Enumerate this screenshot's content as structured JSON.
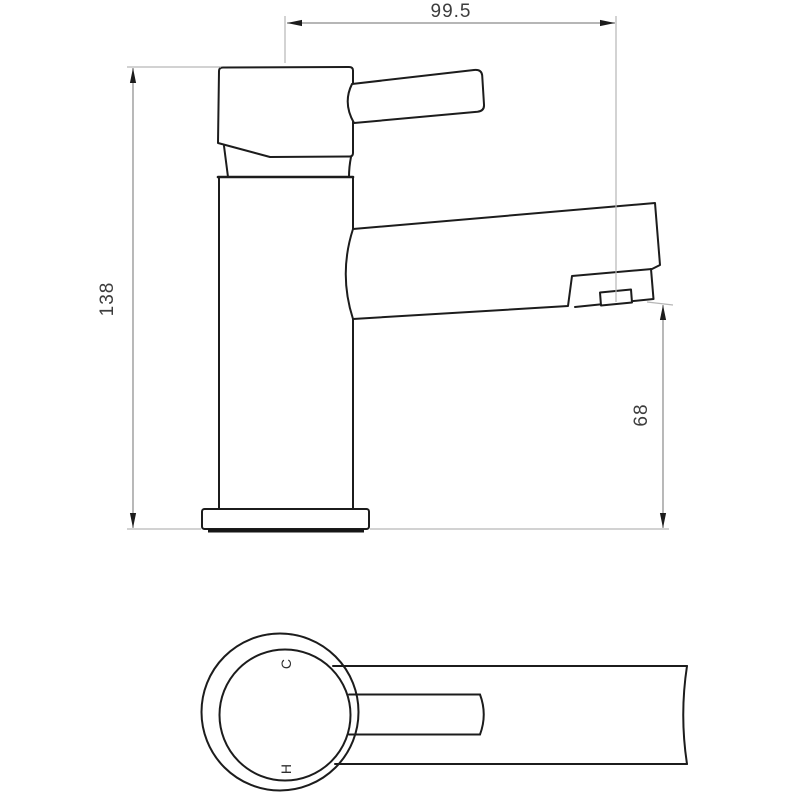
{
  "drawing": {
    "kind": "tap-technical-drawing",
    "dimensions": {
      "spout_reach": "99.5",
      "overall_height": "138",
      "outlet_height": "68"
    },
    "plan_labels": {
      "cold": "C",
      "hot": "H"
    },
    "colors": {
      "background": "#ffffff",
      "outline": "#1c1c1c",
      "dimension_line": "#8a8a8a",
      "extension_line": "#b6b6b6",
      "text": "#3d3d3d"
    }
  }
}
